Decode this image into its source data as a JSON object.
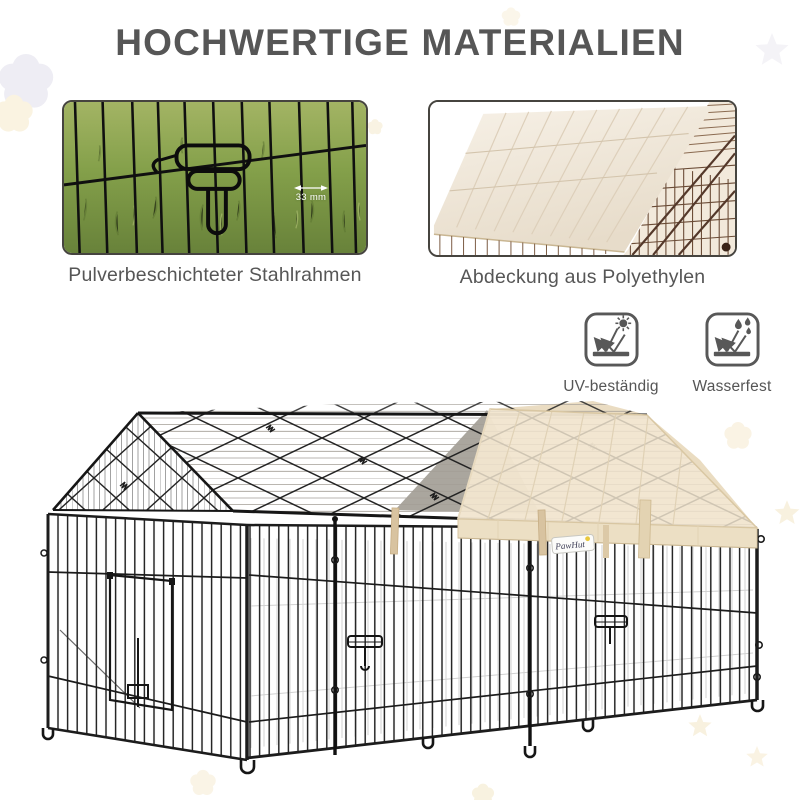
{
  "page": {
    "title": "HOCHWERTIGE MATERIALIEN"
  },
  "insets": {
    "left": {
      "caption": "Pulverbeschichteter Stahlrahmen",
      "measurement": "33 mm"
    },
    "right": {
      "caption": "Abdeckung aus Polyethylen"
    }
  },
  "features": [
    {
      "label": "UV-beständig",
      "icon": "uv-resistant-icon"
    },
    {
      "label": "Wasserfest",
      "icon": "waterproof-icon"
    }
  ],
  "product": {
    "brand": "PawHut"
  },
  "colors": {
    "title_text": "#565656",
    "caption_text": "#565656",
    "steel_frame_black": "#1c1c1c",
    "cover_cream": "#f1e5cf",
    "grass_green": "#84a04a",
    "brand_accent_yellow": "#e9c83d",
    "background": "#ffffff"
  }
}
